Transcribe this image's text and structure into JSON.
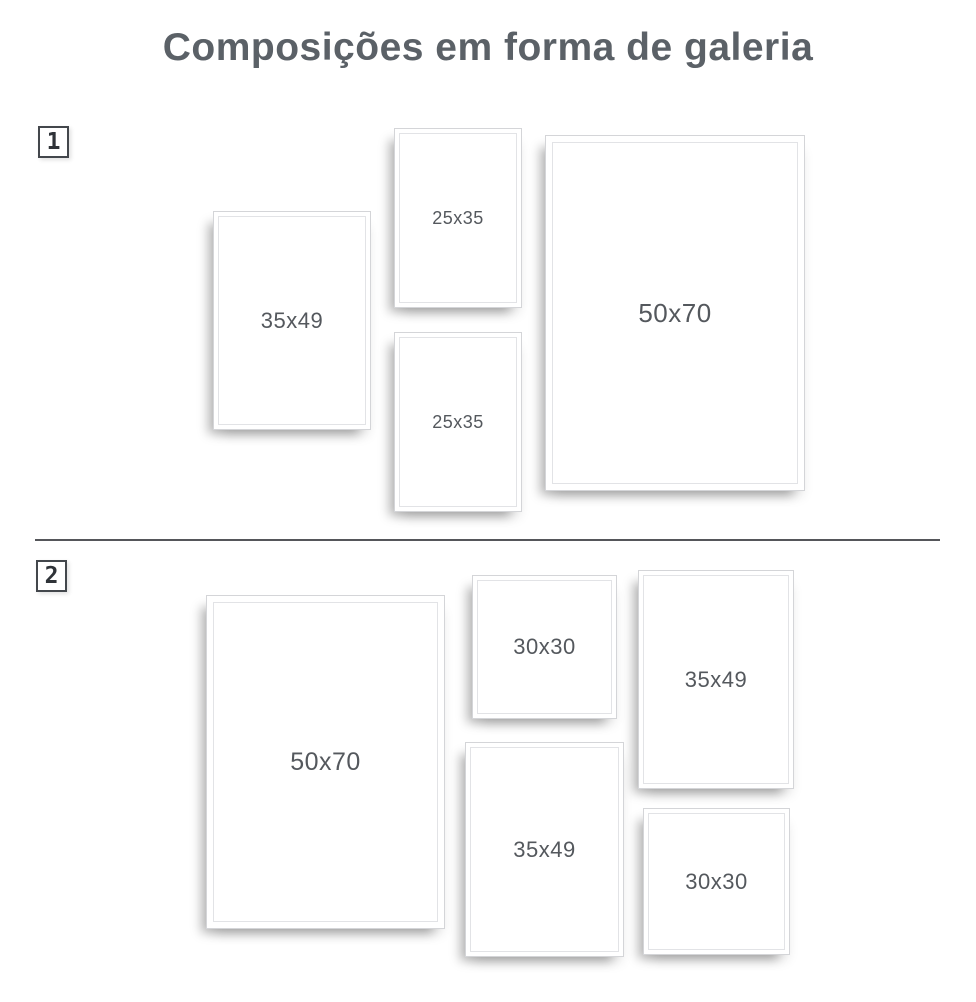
{
  "page": {
    "title": "Composições em forma de galeria"
  },
  "colors": {
    "title_text": "#5b6167",
    "frame_label_text": "#54585d",
    "badge_border": "#43474c",
    "badge_text": "#2f3338",
    "divider": "#55565a",
    "frame_border": "#d4d5d8",
    "frame_inner_line": "#e2e3e6",
    "frame_background": "#ffffff",
    "page_background": "#ffffff"
  },
  "compositions": [
    {
      "badge_label": "1",
      "badge_pos": {
        "left": 38,
        "top": 126
      },
      "frames": [
        {
          "size_label": "35x49",
          "left": 213,
          "top": 211,
          "width": 156,
          "height": 217,
          "label_px": 22
        },
        {
          "size_label": "25x35",
          "left": 394,
          "top": 128,
          "width": 126,
          "height": 178,
          "label_px": 18
        },
        {
          "size_label": "25x35",
          "left": 394,
          "top": 332,
          "width": 126,
          "height": 178,
          "label_px": 18
        },
        {
          "size_label": "50x70",
          "left": 545,
          "top": 135,
          "width": 258,
          "height": 354,
          "label_px": 26
        }
      ]
    },
    {
      "badge_label": "2",
      "badge_pos": {
        "left": 36,
        "top": 560
      },
      "frames": [
        {
          "size_label": "50x70",
          "left": 206,
          "top": 595,
          "width": 237,
          "height": 332,
          "label_px": 25
        },
        {
          "size_label": "30x30",
          "left": 472,
          "top": 575,
          "width": 143,
          "height": 142,
          "label_px": 22
        },
        {
          "size_label": "35x49",
          "left": 638,
          "top": 570,
          "width": 154,
          "height": 217,
          "label_px": 22
        },
        {
          "size_label": "35x49",
          "left": 465,
          "top": 742,
          "width": 157,
          "height": 213,
          "label_px": 22
        },
        {
          "size_label": "30x30",
          "left": 643,
          "top": 808,
          "width": 145,
          "height": 145,
          "label_px": 22
        }
      ]
    }
  ]
}
